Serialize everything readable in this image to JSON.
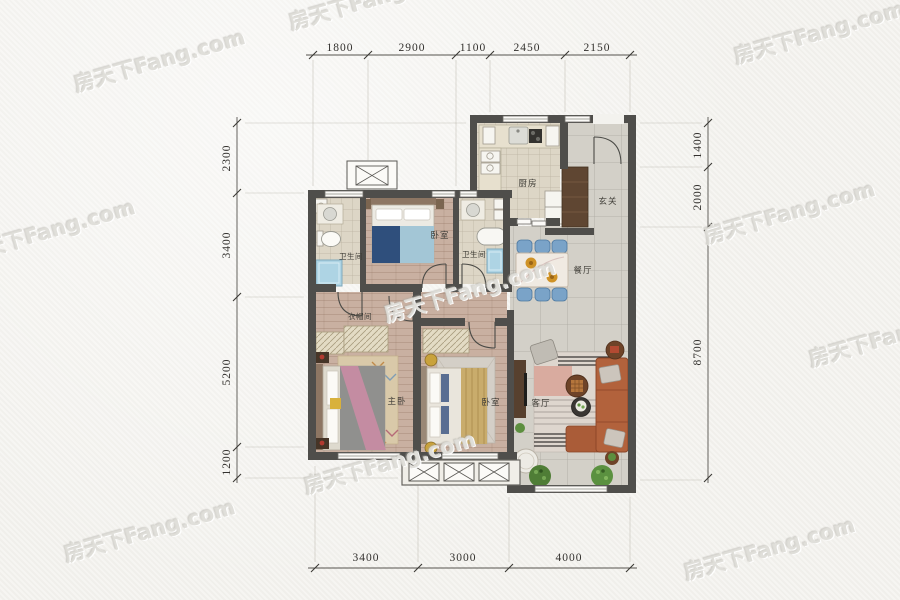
{
  "page": {
    "type": "apartment-floor-plan"
  },
  "watermark": {
    "text": "房天下Fang.com"
  },
  "colors": {
    "paper": "#f3f2ee",
    "wall": "#4f4e4b",
    "wood_floor": "#c9b0a1",
    "tile_warm": "#ddd6c6",
    "tile_cool": "#d3d0c8",
    "balcony": "#f0eee8",
    "sofa": "#b2623c",
    "dining_chair": "#7aa3c8",
    "bed_navy": "#2f4f7c",
    "bed_blue_light": "#a3c6d6",
    "tub_blue": "#aed4e4",
    "plant_green": "#5d8f3f",
    "cabinet_brown": "#5f4632",
    "dim_text": "#33312e"
  },
  "dimensions": {
    "top": [
      "1800",
      "2900",
      "1100",
      "2450",
      "2150"
    ],
    "bottom": [
      "3400",
      "3000",
      "4000"
    ],
    "left": [
      "2300",
      "3400",
      "5200",
      "1200"
    ],
    "right": [
      "1400",
      "2000",
      "8700"
    ]
  },
  "rooms": {
    "kitchen": "厨房",
    "foyer": "玄关",
    "dining": "餐厅",
    "bathroom1": "卫生间",
    "bedroom1": "卧室",
    "bathroom2": "卫生间",
    "cloakroom": "衣帽间",
    "master_bedroom": "主卧",
    "bedroom2": "卧室",
    "living": "客厅"
  }
}
